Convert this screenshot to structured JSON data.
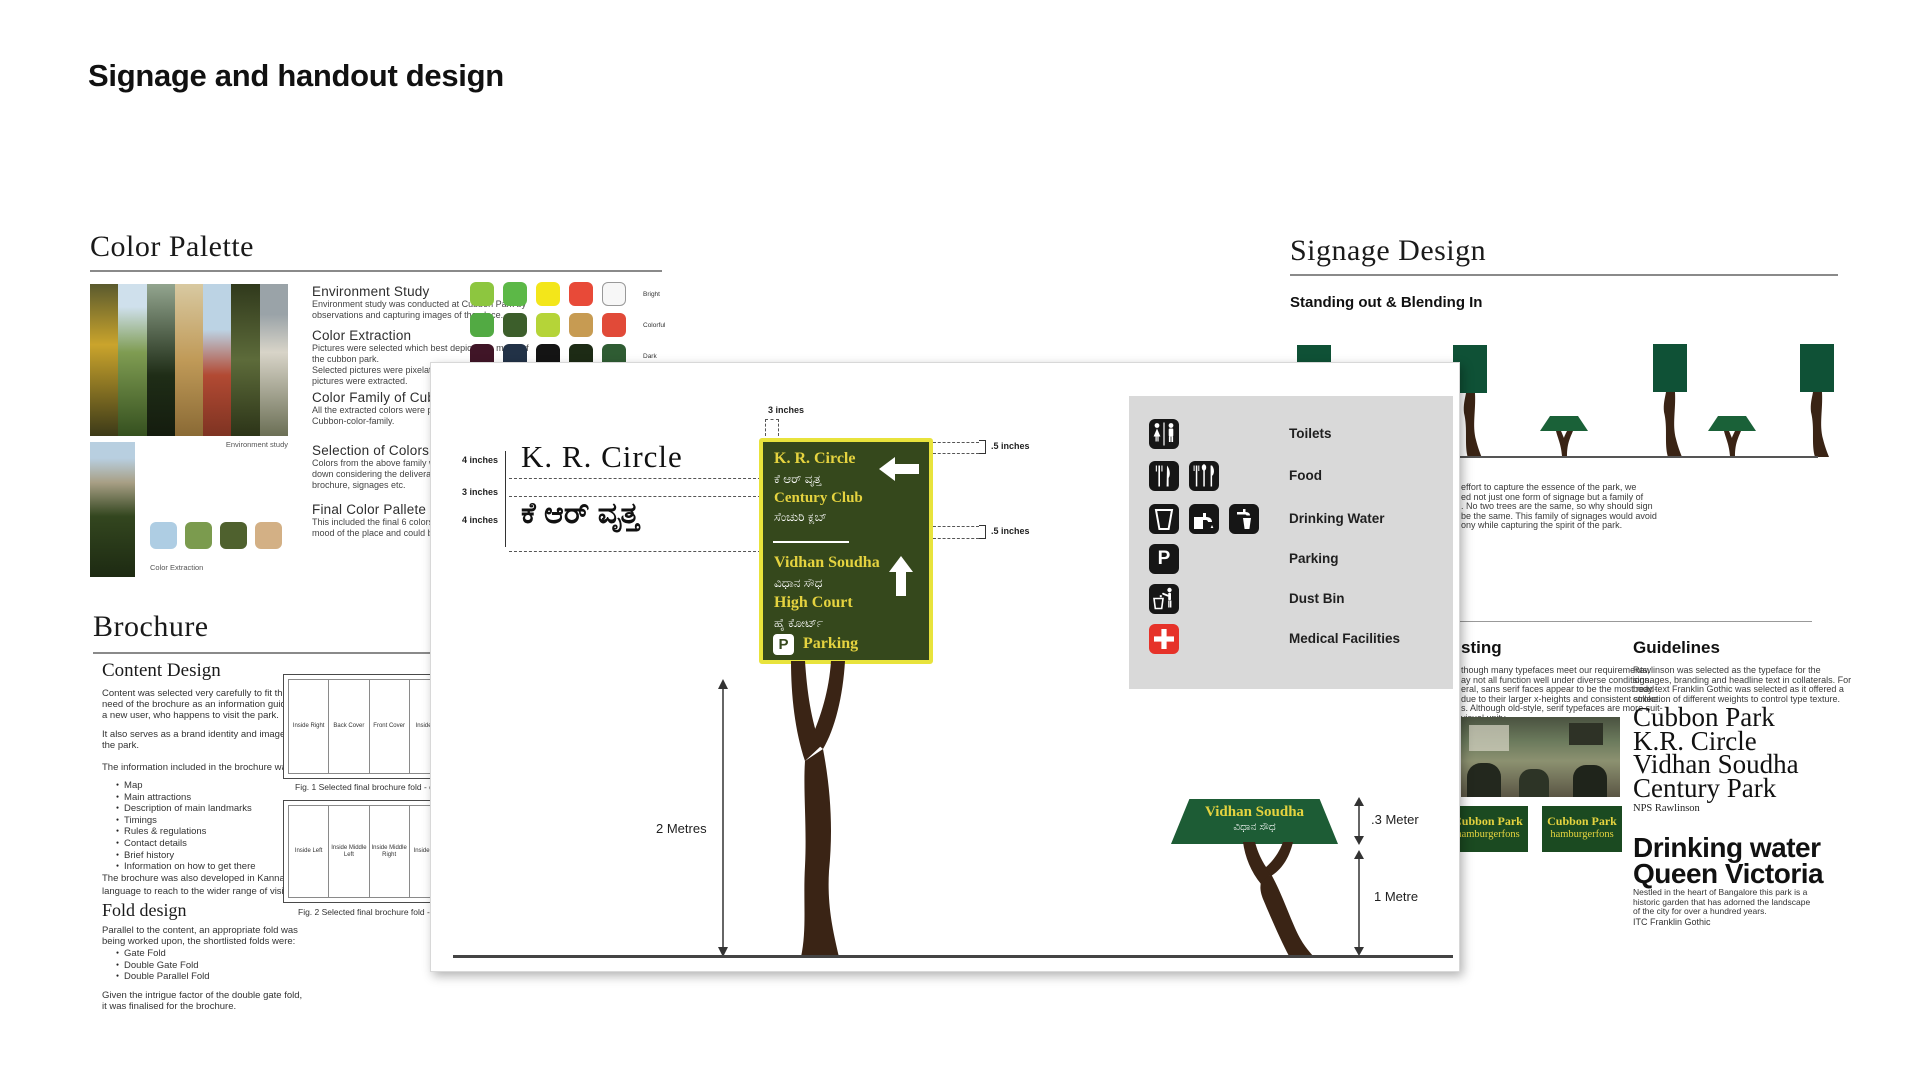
{
  "title": "Signage and handout design",
  "color_palette": {
    "header": "Color Palette",
    "env_caption": "Environment study",
    "extraction_caption": "Color Extraction",
    "sections": [
      {
        "title": "Environment Study",
        "lines": [
          "Environment study was conducted at Cubbon Park by",
          "observations and capturing images of the place."
        ]
      },
      {
        "title": "Color Extraction",
        "lines": [
          "Pictures were selected which best depicts the mood of",
          "the cubbon park.",
          "Selected pictures were pixelated and colors from the",
          "pictures were extracted."
        ]
      },
      {
        "title": "Color Family of Cubbon Park",
        "lines": [
          "All the extracted colors were placed together to",
          "Cubbon-color-family."
        ]
      },
      {
        "title": "Selection of Colors",
        "lines": [
          "Colors from the above family were further narrowed",
          "down considering the deliverables, which included",
          "brochure, signages etc."
        ]
      },
      {
        "title": "Final Color Pallete",
        "lines": [
          "This included the final 6 colors which best depicts",
          "mood of the place and could be followed in deliverables."
        ]
      }
    ],
    "swatch_rows": [
      {
        "label": "Bright",
        "colors": [
          "#8dc63f",
          "#5cb847",
          "#f3e61a",
          "#e84a38",
          "#f7f7f7"
        ]
      },
      {
        "label": "Colorful",
        "colors": [
          "#52aa43",
          "#3c5e2b",
          "#b5d438",
          "#c79b52",
          "#e14a38"
        ]
      },
      {
        "label": "Dark",
        "colors": [
          "#401527",
          "#223247",
          "#141414",
          "#1d2b15",
          "#2f5c33"
        ]
      }
    ],
    "extraction_swatches": [
      "#aecde3",
      "#7b9b4e",
      "#4f612e",
      "#d3b085"
    ]
  },
  "brochure": {
    "header": "Brochure",
    "content_design_title": "Content Design",
    "para1": [
      "Content was selected very carefully to fit the",
      "need of the brochure as an information guide for",
      "a new user, who happens to visit the park."
    ],
    "para2": [
      "It also serves as a brand identity and image for",
      "the park."
    ],
    "para3": "The information included in the brochure was:",
    "bullets": [
      "Map",
      "Main attractions",
      "Description of main landmarks",
      "Timings",
      "Rules & regulations",
      "Contact details",
      "Brief history",
      "Information on how to get there"
    ],
    "para4": [
      "The brochure was also developed in Kannada",
      "language to reach to the wider range of visitors."
    ],
    "fold_design_title": "Fold design",
    "para5": [
      "Parallel to the content, an appropriate fold was",
      "being worked upon, the shortlisted folds were:"
    ],
    "fold_bullets": [
      "Gate Fold",
      "Double Gate Fold",
      "Double Parallel Fold"
    ],
    "para6": [
      "Given the intrigue factor of the double gate fold,",
      "it was finalised for the brochure."
    ],
    "fig1": {
      "panels": [
        "Inside Right",
        "Back Cover",
        "Front Cover",
        "Inside Left"
      ],
      "caption": "Fig. 1 Selected final brochure fold - outside"
    },
    "fig2": {
      "panels": [
        "Inside Left",
        "Inside Middle Left",
        "Inside Middle Right",
        "Inside Right"
      ],
      "caption": "Fig. 2 Selected final brochure fold - inside"
    }
  },
  "panel": {
    "spec": {
      "top_dim": "3 inches",
      "side_dims": [
        "4 inches",
        "3 inches",
        "4 inches"
      ],
      "latin": "K. R. Circle",
      "kannada": "ಕೆ ಆರ್ ವೃತ್ತ",
      "right_dim_top": ".5 inches",
      "right_dim_mid": ".5 inches",
      "height_dim": "2 Metres"
    },
    "sign": {
      "line1": "K. R. Circle",
      "line1_kn": "ಕೆ ಆರ್ ವೃತ್ತ",
      "line2": "Century Club",
      "line2_kn": "ಸೆಂಚುರಿ ಕ್ಲಬ್",
      "line3": "Vidhan Soudha",
      "line3_kn": "ವಿಧಾನ ಸೌಧ",
      "line4": "High Court",
      "line4_kn": "ಹೈ ಕೋರ್ಟ್",
      "parking_letter": "P",
      "parking": "Parking"
    },
    "legend": {
      "rows": [
        {
          "label": "Toilets",
          "icons": [
            "toilets"
          ]
        },
        {
          "label": "Food",
          "icons": [
            "fork-knife",
            "cutlery"
          ]
        },
        {
          "label": "Drinking Water",
          "icons": [
            "cup",
            "tap",
            "tap-glass"
          ]
        },
        {
          "label": "Parking",
          "icons": [
            "parking"
          ]
        },
        {
          "label": "Dust Bin",
          "icons": [
            "dustbin"
          ]
        },
        {
          "label": "Medical Facilities",
          "icons": [
            "medical-cross"
          ]
        }
      ]
    },
    "small_sign": {
      "latin": "Vidhan Soudha",
      "kannada": "ವಿಧಾನ ಸೌಧ"
    },
    "small_dims": {
      "height": ".3 Meter",
      "pole": "1 Metre"
    }
  },
  "signage": {
    "header": "Signage Design",
    "subheader": "Standing out & Blending In",
    "intro_lines": [
      "effort to capture the essence of the park, we",
      "ed not just one form of signage but a family of",
      ". No two trees are the same, so why should sign",
      "be the same. This family of signages would avoid",
      "ony while capturing the spirit of the park."
    ],
    "testing": {
      "header": "sting",
      "lines": [
        "though many typefaces meet our requirements,",
        "ay not all function well under diverse conditions.",
        "eral, sans serif faces appear to be the most read-",
        "due to their larger x-heights and consistent stroke",
        "s. Although old-style, serif typefaces are more suit-",
        "visual unity."
      ]
    },
    "guidelines": {
      "header": "Guidelines",
      "lines": [
        "Rawlinson was selected as the typeface for the",
        "signages, branding and headline text in collaterals. For",
        "body text Franklin Gothic was selected as it offered a",
        "collection of different weights to control type texture."
      ],
      "serif_specimen": [
        "Cubbon Park",
        "K.R. Circle",
        "Vidhan Soudha",
        "Century Park"
      ],
      "serif_caption": "NPS Rawlinson",
      "sans_specimen": [
        "Drinking water",
        "Queen Victoria"
      ],
      "sans_lines": [
        "Nestled in the heart of Bangalore this park is a",
        "historic garden that has adorned the landscape",
        "of the city for over a hundred years."
      ],
      "sans_caption": "ITC Franklin Gothic"
    },
    "badge": {
      "line1": "Cubbon Park",
      "line2": "hamburgerfons"
    }
  },
  "colors": {
    "sign_green": "#35481c",
    "sign_border_yellow": "#e8e33c",
    "sign_text_yellow": "#e5d33f",
    "tree_brown": "#3a2415",
    "tree_sign_green": "#0f5136",
    "trapezoid_green": "#1a6138",
    "small_sign_green": "#1d5c35",
    "badge_green": "#1b4a21",
    "legend_bg": "#d9d9d9",
    "icon_black": "#161616",
    "medical_red": "#e63229"
  }
}
